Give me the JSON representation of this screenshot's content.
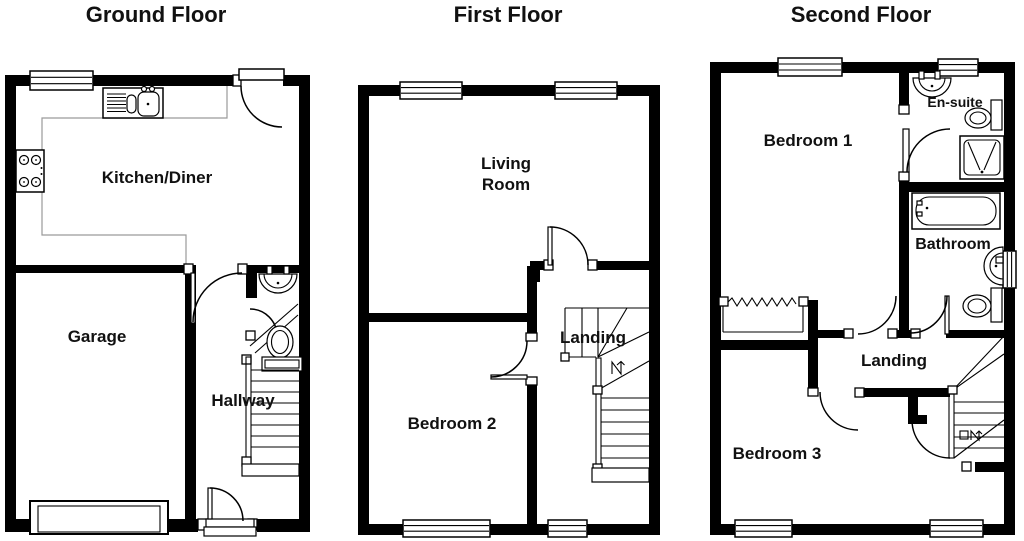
{
  "colors": {
    "background": "#ffffff",
    "walls": "#000000",
    "fixture_lines": "#000000",
    "counter_line": "#9a9a9a",
    "label_text": "#111111"
  },
  "floors": [
    {
      "title": "Ground Floor",
      "rooms": {
        "kitchen": "Kitchen/Diner",
        "garage": "Garage",
        "hallway": "Hallway"
      }
    },
    {
      "title": "First Floor",
      "rooms": {
        "living_line1": "Living",
        "living_line2": "Room",
        "bedroom2": "Bedroom 2",
        "landing": "Landing"
      }
    },
    {
      "title": "Second Floor",
      "rooms": {
        "bedroom1": "Bedroom 1",
        "ensuite": "En-suite",
        "bathroom": "Bathroom",
        "landing": "Landing",
        "bedroom3": "Bedroom 3"
      }
    }
  ]
}
